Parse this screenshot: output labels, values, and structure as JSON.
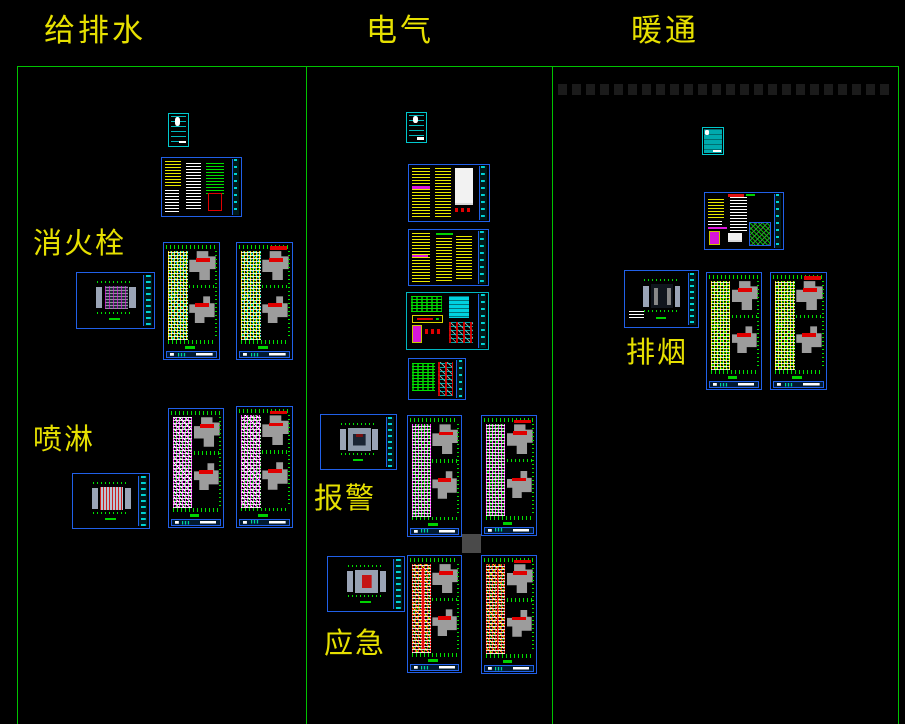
{
  "window": {
    "width": 905,
    "height": 724,
    "background": "#000000"
  },
  "columns": [
    {
      "id": "plumbing",
      "header": "给排水"
    },
    {
      "id": "electrical",
      "header": "电气"
    },
    {
      "id": "hvac",
      "header": "暖通"
    }
  ],
  "group_labels": [
    {
      "id": "hydrant",
      "text": "消火栓"
    },
    {
      "id": "sprinkler",
      "text": "喷淋"
    },
    {
      "id": "alarm",
      "text": "报警"
    },
    {
      "id": "emergency",
      "text": "应急"
    },
    {
      "id": "smoke-exhaust",
      "text": "排烟"
    }
  ],
  "colors": {
    "background": "#000000",
    "frame_green": "#00c300",
    "label_yellow": "#e6e000",
    "sheet_border_blue": "#2160e8",
    "sheet_border_cyan": "#00c8cd",
    "tick_green": "#00e000",
    "building_gray": "#9c9c9c",
    "annotation_red": "#e00000",
    "annotation_magenta": "#e018e0",
    "text_yellow": "#e8e800",
    "text_white": "#ffffff",
    "title_strip_cyan": "#00d2d2"
  },
  "canvas": {
    "frame": {
      "top_y": 66,
      "bottom_y": 724,
      "column_x": [
        17,
        306,
        552,
        898
      ]
    },
    "header_positions": [
      {
        "x": 44,
        "y": 16
      },
      {
        "x": 366,
        "y": 16
      },
      {
        "x": 631,
        "y": 16
      }
    ],
    "group_label_positions": [
      {
        "x": 33,
        "y": 229
      },
      {
        "x": 33,
        "y": 425
      },
      {
        "x": 314,
        "y": 484
      },
      {
        "x": 324,
        "y": 629
      },
      {
        "x": 626,
        "y": 338
      }
    ],
    "sheets": [
      {
        "name": "plumbing-cover-sheet",
        "type": "doc",
        "variant": "lines",
        "x": 168,
        "y": 113,
        "w": 21,
        "h": 34
      },
      {
        "name": "plumbing-notes-sheet",
        "type": "notes",
        "variant": "v1",
        "x": 161,
        "y": 157,
        "w": 81,
        "h": 60
      },
      {
        "name": "hydrant-site-plan",
        "type": "plan-small",
        "variant": "hydrant",
        "x": 76,
        "y": 272,
        "w": 79,
        "h": 57
      },
      {
        "name": "hydrant-floor-plan-1",
        "type": "plan-tall",
        "variant": "hydrant",
        "x": 163,
        "y": 242,
        "w": 57,
        "h": 118
      },
      {
        "name": "hydrant-floor-plan-2",
        "type": "plan-tall",
        "variant": "hydrant2",
        "x": 236,
        "y": 242,
        "w": 57,
        "h": 118
      },
      {
        "name": "sprinkler-site-plan",
        "type": "plan-small",
        "variant": "spray",
        "x": 72,
        "y": 473,
        "w": 78,
        "h": 56
      },
      {
        "name": "sprinkler-floor-plan-1",
        "type": "plan-tall",
        "variant": "spray",
        "x": 168,
        "y": 408,
        "w": 56,
        "h": 120
      },
      {
        "name": "sprinkler-floor-plan-2",
        "type": "plan-tall",
        "variant": "spray2",
        "x": 236,
        "y": 406,
        "w": 57,
        "h": 122
      },
      {
        "name": "electrical-cover-sheet",
        "type": "doc",
        "variant": "lines",
        "x": 406,
        "y": 112,
        "w": 21,
        "h": 31
      },
      {
        "name": "electrical-notes-sheet-1",
        "type": "notes",
        "variant": "v2",
        "x": 408,
        "y": 164,
        "w": 82,
        "h": 58
      },
      {
        "name": "electrical-notes-sheet-2",
        "type": "notes",
        "variant": "v3",
        "x": 408,
        "y": 229,
        "w": 81,
        "h": 57
      },
      {
        "name": "electrical-legend-sheet",
        "type": "notes",
        "variant": "v4",
        "x": 406,
        "y": 292,
        "w": 83,
        "h": 58
      },
      {
        "name": "electrical-detail-sheet",
        "type": "notes",
        "variant": "v6",
        "x": 408,
        "y": 358,
        "w": 58,
        "h": 42
      },
      {
        "name": "alarm-site-plan",
        "type": "plan-small",
        "variant": "alarm",
        "x": 320,
        "y": 414,
        "w": 77,
        "h": 56
      },
      {
        "name": "alarm-floor-plan-1",
        "type": "plan-tall",
        "variant": "alarm",
        "x": 407,
        "y": 415,
        "w": 55,
        "h": 122
      },
      {
        "name": "alarm-floor-plan-2",
        "type": "plan-tall",
        "variant": "alarm2",
        "x": 481,
        "y": 415,
        "w": 56,
        "h": 121
      },
      {
        "name": "selection-grip-square",
        "type": "misc-square",
        "x": 462,
        "y": 534,
        "w": 19,
        "h": 19
      },
      {
        "name": "emergency-site-plan",
        "type": "plan-small",
        "variant": "emerg",
        "x": 327,
        "y": 556,
        "w": 78,
        "h": 56
      },
      {
        "name": "emergency-floor-plan-1",
        "type": "plan-tall",
        "variant": "emerg",
        "x": 407,
        "y": 555,
        "w": 55,
        "h": 118
      },
      {
        "name": "emergency-floor-plan-2",
        "type": "plan-tall",
        "variant": "emerg2",
        "x": 481,
        "y": 555,
        "w": 56,
        "h": 119
      },
      {
        "name": "hvac-cover-sheet",
        "type": "doc",
        "variant": "filled",
        "x": 702,
        "y": 127,
        "w": 22,
        "h": 28
      },
      {
        "name": "hvac-notes-sheet",
        "type": "notes",
        "variant": "v5",
        "x": 704,
        "y": 192,
        "w": 80,
        "h": 58
      },
      {
        "name": "smoke-exhaust-site-plan",
        "type": "plan-small",
        "variant": "smoke",
        "x": 624,
        "y": 270,
        "w": 75,
        "h": 58
      },
      {
        "name": "smoke-exhaust-floor-plan-1",
        "type": "plan-tall",
        "variant": "smoke",
        "x": 706,
        "y": 272,
        "w": 56,
        "h": 118
      },
      {
        "name": "smoke-exhaust-floor-plan-2",
        "type": "plan-tall",
        "variant": "smoke2",
        "x": 770,
        "y": 272,
        "w": 57,
        "h": 118
      },
      {
        "name": "faint-dash-row",
        "type": "dash-row",
        "x": 558,
        "y": 84,
        "w": 335,
        "h": 11
      }
    ]
  }
}
